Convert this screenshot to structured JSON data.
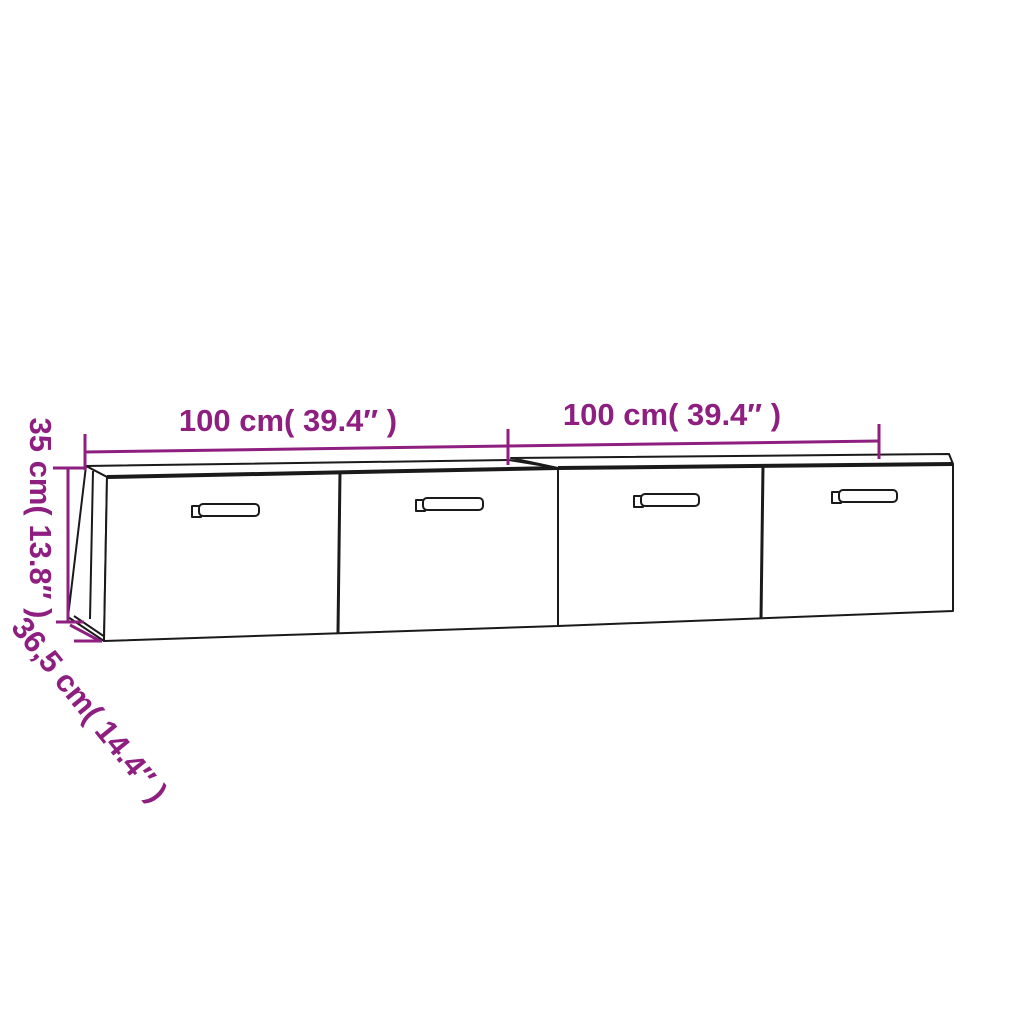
{
  "diagram": {
    "colors": {
      "dimension_accent": "#8E1F80",
      "outline": "#1A1A1A",
      "background": "#FFFFFF"
    },
    "labels": {
      "width_left": "100 cm( 39.4″ )",
      "width_right": "100 cm( 39.4″ )",
      "height": "35 cm( 13.8″ )",
      "depth": "36,5 cm( 14.4″ )"
    }
  }
}
